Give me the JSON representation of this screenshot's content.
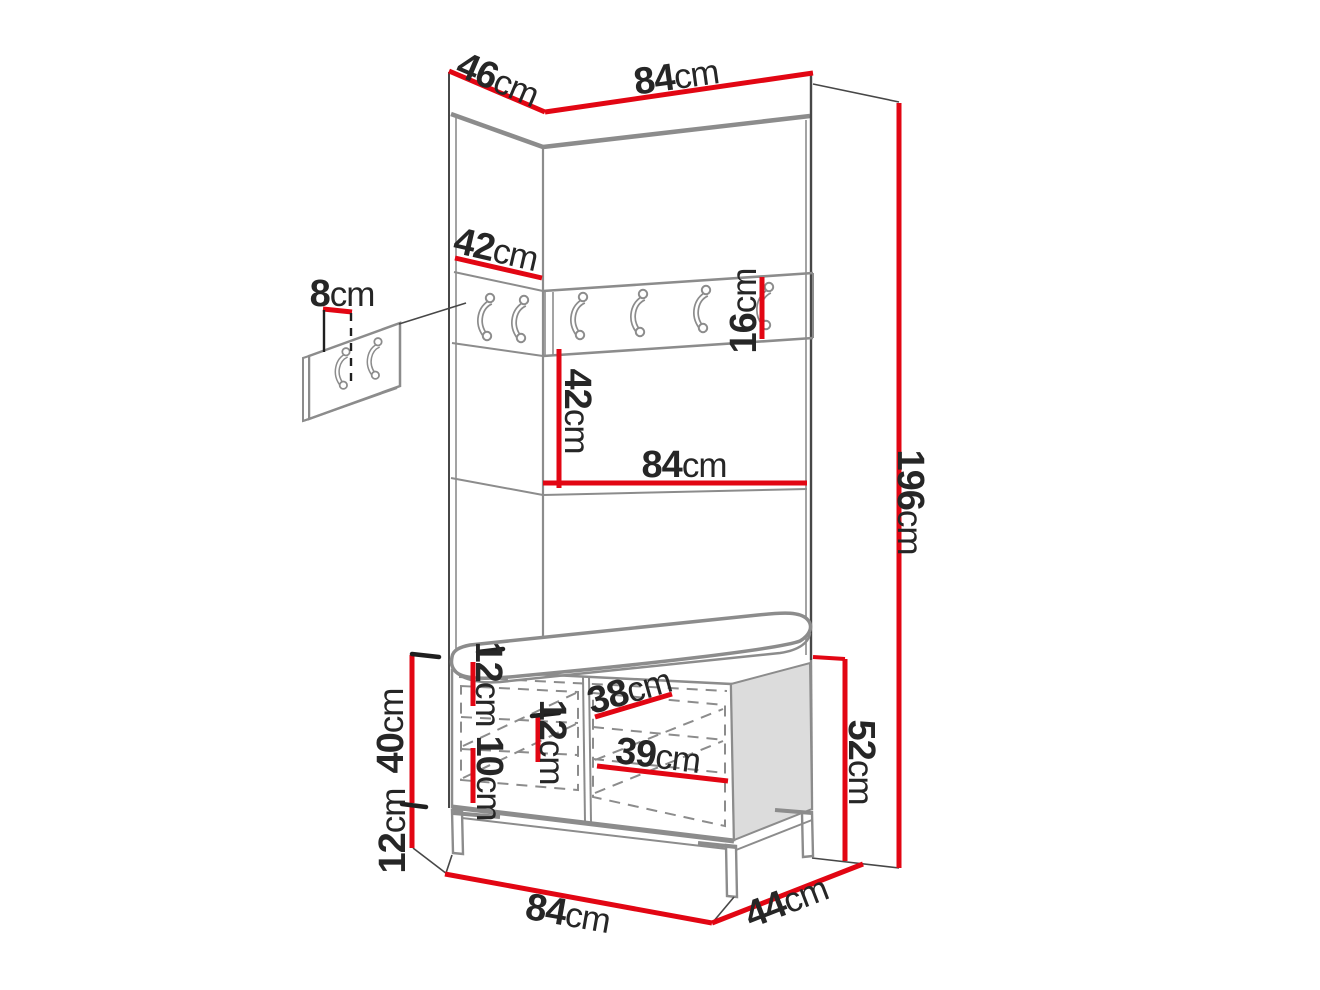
{
  "diagram": {
    "type": "furniture-dimension-diagram",
    "colors": {
      "dimension_line": "#e20613",
      "text": "#262626",
      "outline": "#8c8c8c",
      "outline_dark": "#474747",
      "panel_fill": "#ffffff",
      "side_panel_fill": "#dcdcdc",
      "background": "#ffffff"
    },
    "counts": {
      "hook_rail_hooks": 6,
      "wall_panel_hooks": 2
    },
    "dimensions": {
      "top_side_depth": {
        "value": "46",
        "unit": "cm"
      },
      "top_width": {
        "value": "84",
        "unit": "cm"
      },
      "upper_side_panel": {
        "value": "42",
        "unit": "cm"
      },
      "wall_hook_panel": {
        "value": "8",
        "unit": "cm"
      },
      "hook_rail_height": {
        "value": "16",
        "unit": "cm"
      },
      "middle_section": {
        "value": "42",
        "unit": "cm"
      },
      "middle_shelf_width": {
        "value": "84",
        "unit": "cm"
      },
      "total_height": {
        "value": "196",
        "unit": "cm"
      },
      "bench_top_offset": {
        "value": "12",
        "unit": "cm"
      },
      "bench_middle_offset": {
        "value": "12",
        "unit": "cm"
      },
      "bench_shelf_offset": {
        "value": "10",
        "unit": "cm"
      },
      "door_upper_width": {
        "value": "38",
        "unit": "cm"
      },
      "door_lower_width": {
        "value": "39",
        "unit": "cm"
      },
      "bench_cabinet_height": {
        "value": "40",
        "unit": "cm"
      },
      "bench_leg_height": {
        "value": "12",
        "unit": "cm"
      },
      "bench_total_height": {
        "value": "52",
        "unit": "cm"
      },
      "bench_width": {
        "value": "84",
        "unit": "cm"
      },
      "bench_depth": {
        "value": "44",
        "unit": "cm"
      }
    }
  }
}
